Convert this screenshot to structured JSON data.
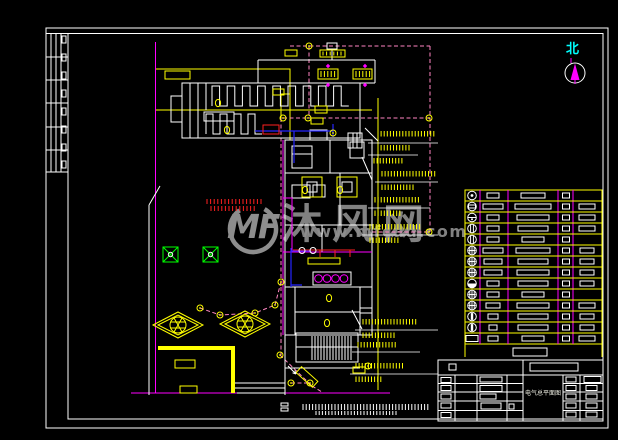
{
  "palette": {
    "background": "#000000",
    "line_white": "#ffffff",
    "line_yellow": "#ffff00",
    "line_magenta": "#ff00ff",
    "line_pink_dashed": "#ff85c2",
    "line_blue": "#2424ff",
    "line_red": "#ff2020",
    "line_green": "#00ff00",
    "line_cyan": "#00ffff",
    "watermark_gray": "#8f8f8f"
  },
  "watermark": {
    "logo": "MF",
    "site_name": "沐风网",
    "url": "www.mfcad.com"
  },
  "north_arrow": {
    "label": "北"
  },
  "title_block": {
    "drawing_title": "电气总平面图"
  },
  "legend": {
    "top": 190,
    "row_h": 11,
    "rows": [
      {
        "s": "dot",
        "w2": 12,
        "w3": 24,
        "w5": 0
      },
      {
        "s": "hbar",
        "w2": 20,
        "w3": 36,
        "w5": 16
      },
      {
        "s": "half",
        "w2": 12,
        "w3": 32,
        "w5": 16
      },
      {
        "s": "vlines",
        "w2": 12,
        "w3": 30,
        "w5": 16
      },
      {
        "s": "vlines",
        "w2": 12,
        "w3": 22,
        "w5": 0
      },
      {
        "s": "grid",
        "w2": 20,
        "w3": 34,
        "w5": 14
      },
      {
        "s": "grid",
        "w2": 18,
        "w3": 30,
        "w5": 14
      },
      {
        "s": "grid",
        "w2": 18,
        "w3": 32,
        "w5": 14
      },
      {
        "s": "fill",
        "w2": 12,
        "w3": 30,
        "w5": 14
      },
      {
        "s": "grid",
        "w2": 12,
        "w3": 22,
        "w5": 0
      },
      {
        "s": "grid",
        "w2": 14,
        "w3": 32,
        "w5": 16
      },
      {
        "s": "vbar",
        "w2": 10,
        "w3": 30,
        "w5": 14
      },
      {
        "s": "vbar",
        "w2": 8,
        "w3": 30,
        "w5": 14
      },
      {
        "s": "box",
        "w2": 10,
        "w3": 22,
        "w5": 16
      }
    ]
  },
  "plan": {
    "lamps": [
      [
        309,
        46
      ],
      [
        283,
        118
      ],
      [
        308,
        118
      ],
      [
        333,
        133
      ],
      [
        429,
        118
      ],
      [
        429,
        232
      ],
      [
        281,
        282
      ],
      [
        280,
        355
      ],
      [
        275,
        305
      ],
      [
        255,
        313
      ],
      [
        220,
        315
      ],
      [
        200,
        308
      ],
      [
        291,
        383
      ],
      [
        310,
        383
      ],
      [
        368,
        366
      ]
    ],
    "oval_fixtures": [
      [
        218,
        103
      ],
      [
        227,
        130
      ],
      [
        305,
        190
      ],
      [
        340,
        190
      ],
      [
        329,
        298
      ],
      [
        327,
        323
      ]
    ],
    "combs": [
      {
        "x": 212,
        "y": 86,
        "h": 20,
        "w": 7.6,
        "n": 9
      },
      {
        "x": 206,
        "y": 114,
        "h": 20,
        "w": 7,
        "n": 4
      }
    ],
    "hatch_groups": [
      {
        "name": "stair-treads",
        "x": 312,
        "y": 336,
        "n": 14,
        "step": 3,
        "h": 24,
        "color": "#ffffff"
      },
      {
        "name": "scale-text-row1",
        "x": 303,
        "y": 404,
        "n": 40,
        "step": 3.2,
        "h": 6,
        "color": "#ffffff"
      },
      {
        "name": "scale-text-row2",
        "x": 316,
        "y": 411,
        "n": 26,
        "step": 3.2,
        "h": 4,
        "color": "#ffffff"
      },
      {
        "name": "red-note-row1",
        "x": 207,
        "y": 199,
        "n": 16,
        "step": 3.6,
        "h": 5,
        "color": "#ff2020"
      },
      {
        "name": "red-note-row2",
        "x": 211,
        "y": 206,
        "n": 13,
        "step": 3.6,
        "h": 5,
        "color": "#ff2020"
      },
      {
        "name": "label-glyphs-1",
        "x": 321,
        "y": 71,
        "n": 5,
        "step": 3.4,
        "h": 6,
        "color": "#ffff00"
      },
      {
        "name": "label-glyphs-2",
        "x": 356,
        "y": 71,
        "n": 5,
        "step": 3.4,
        "h": 6,
        "color": "#ffff00"
      },
      {
        "name": "label-glyphs-3",
        "x": 323,
        "y": 51.5,
        "n": 6,
        "step": 3.6,
        "h": 4,
        "color": "#ffff00"
      }
    ],
    "wiring_callouts": [
      {
        "y": 143,
        "x1": 368,
        "x2": 438,
        "ticks": [
          {
            "x": 378,
            "y": 131,
            "n": 19
          },
          {
            "x": 378,
            "y": 145,
            "n": 11
          }
        ]
      },
      {
        "y": 155,
        "x1": 368,
        "x2": 418,
        "ticks": [
          {
            "x": 374,
            "y": 158,
            "n": 10
          }
        ]
      },
      {
        "y": 182,
        "x1": 375,
        "x2": 438,
        "ticks": [
          {
            "x": 382,
            "y": 171,
            "n": 18
          },
          {
            "x": 382,
            "y": 184.5,
            "n": 11
          }
        ]
      },
      {
        "y": 208,
        "x1": 368,
        "x2": 430,
        "ticks": [
          {
            "x": 375,
            "y": 197,
            "n": 15
          },
          {
            "x": 375,
            "y": 210.5,
            "n": 9
          }
        ]
      },
      {
        "y": 235,
        "x1": 362,
        "x2": 438,
        "ticks": [
          {
            "x": 370,
            "y": 224,
            "n": 17
          },
          {
            "x": 370,
            "y": 237.5,
            "n": 10
          }
        ]
      },
      {
        "y": 330,
        "x1": 355,
        "x2": 438,
        "ticks": [
          {
            "x": 363,
            "y": 319,
            "n": 18
          },
          {
            "x": 363,
            "y": 332.5,
            "n": 11
          }
        ]
      },
      {
        "y": 352,
        "x1": 352,
        "x2": 420,
        "ticks": [
          {
            "x": 358,
            "y": 342,
            "n": 13
          }
        ]
      },
      {
        "y": 374,
        "x1": 350,
        "x2": 438,
        "ticks": [
          {
            "x": 356,
            "y": 363,
            "n": 16
          },
          {
            "x": 356,
            "y": 376.5,
            "n": 9
          }
        ]
      }
    ]
  },
  "strip": {
    "row_ys": [
      33.5,
      57,
      80,
      103,
      127,
      150,
      172
    ],
    "col_xs": [
      51,
      56,
      61
    ],
    "cell_ys": [
      36,
      54,
      72,
      90,
      108,
      126,
      144,
      161
    ]
  }
}
